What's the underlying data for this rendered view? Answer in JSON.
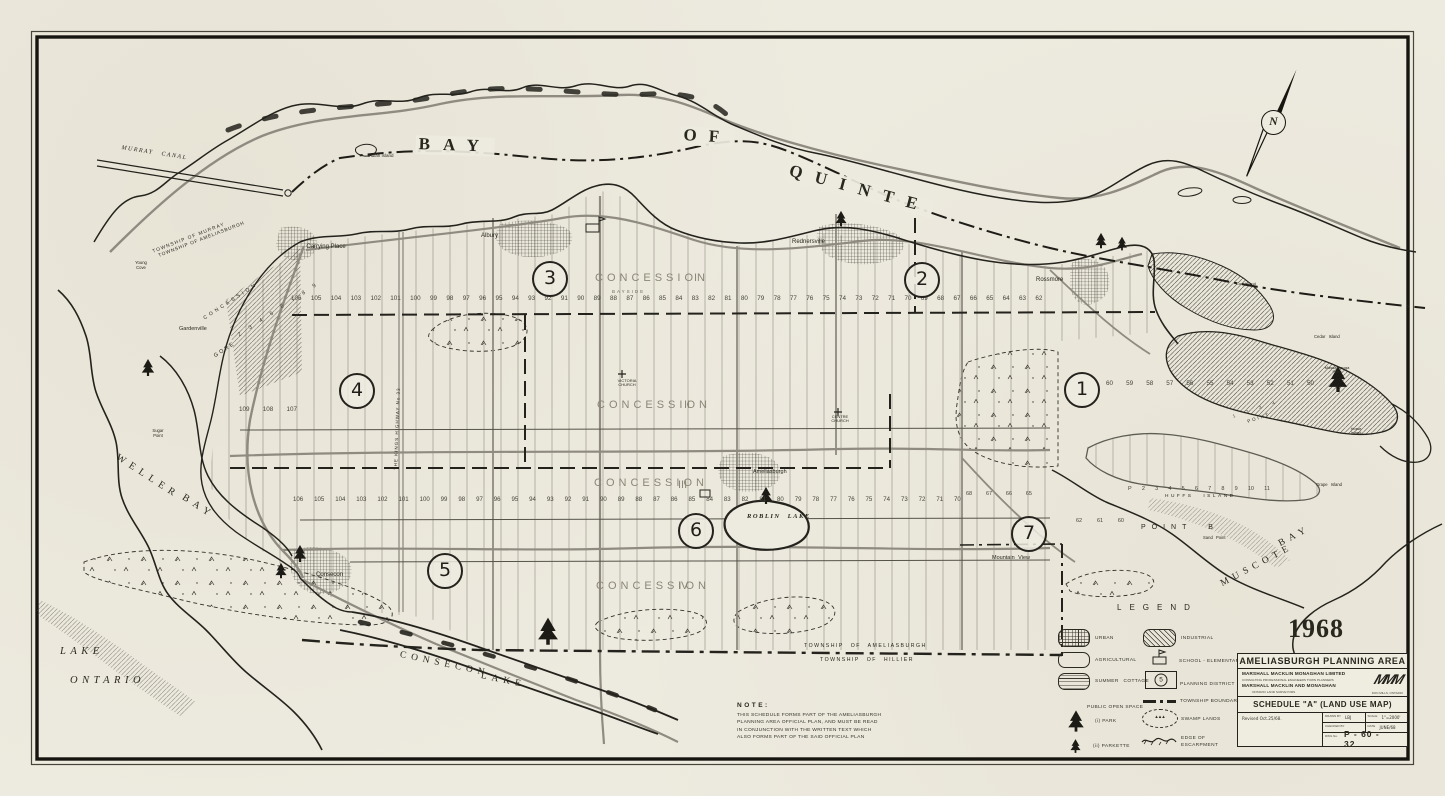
{
  "map": {
    "year": "1968",
    "compass": "N",
    "water": {
      "bay_of_quinte": [
        "BAY",
        "OF",
        "QUINTE"
      ],
      "lake_ontario": [
        "LAKE",
        "ONTARIO"
      ],
      "weller_bay": [
        "WELLER",
        "BAY"
      ],
      "consecon_lake": [
        "CONSECON",
        "LAKE"
      ],
      "muscote_bay": [
        "MUSCOTE",
        "BAY"
      ],
      "roblin_lake": "ROBLIN LAKE",
      "murray_canal": "MURRAY CANAL"
    },
    "places": {
      "carrying_place": "Carrying Place",
      "albury": "Albury",
      "rednersville": "Rednersville",
      "rossmore": "Rossmore",
      "gardenville": "Gardenville",
      "consecon": "Consecon",
      "ameliasburgh": "Ameliasburgh",
      "mountain_view": "Mountain View",
      "victoria_church": "VICTORIA CHURCH",
      "centre_church": "CENTRE CHURCH",
      "young_cove": "Young Cove",
      "sugar_point": "Sugar Point",
      "sand_point": "Sand Point",
      "point_b": "POINT B",
      "point_small": "POINT",
      "gore": "GORE",
      "concession_strip": "CONCESSION",
      "kings_highway": "THE KINGS HIGHWAY No 33"
    },
    "islands": {
      "indian": "Indian Island",
      "huffs": "HUFFS ISLAND",
      "grape": "Grape Island",
      "cow": "Cow Island",
      "cedar": "Cedar Island",
      "horse": "Horse Island",
      "massassauga": "Massassauga Point"
    },
    "townships": {
      "murray": "TOWNSHIP OF MURRAY",
      "ameliasburgh_top": "TOWNSHIP OF AMELIASBURGH",
      "ameliasburgh_bottom": "TOWNSHIP OF AMELIASBURGH",
      "hillier": "TOWNSHIP OF HILLIER"
    },
    "concessions": [
      {
        "label": "CONCESSION",
        "numeral": "I",
        "sub": "BAYSIDE"
      },
      {
        "label": "CONCESSION",
        "numeral": "II"
      },
      {
        "label": "CONCESSION",
        "numeral": "III"
      },
      {
        "label": "CONCESSION",
        "numeral": "IV"
      }
    ],
    "districts": [
      "1",
      "2",
      "3",
      "4",
      "5",
      "6",
      "7"
    ],
    "lot_rows": {
      "concession1": [
        106,
        105,
        104,
        103,
        102,
        101,
        100,
        99,
        98,
        97,
        96,
        95,
        94,
        93,
        92,
        91,
        90,
        89,
        88,
        87,
        86,
        85,
        84,
        83,
        82,
        81,
        80,
        79,
        78,
        77,
        76,
        75,
        74,
        73,
        72,
        71,
        70,
        69,
        68,
        67,
        66,
        65,
        64,
        63,
        62
      ],
      "left_upper": [
        109,
        108,
        107
      ],
      "east": [
        60,
        59,
        58,
        57,
        56,
        55,
        54,
        53,
        52,
        51,
        50
      ],
      "concession3": [
        106,
        105,
        104,
        103,
        102,
        101,
        100,
        99,
        98,
        97,
        96,
        95,
        94,
        93,
        92,
        91,
        90,
        89,
        88,
        87,
        86,
        85,
        84,
        83,
        82,
        81,
        80,
        79,
        78,
        77,
        76,
        75,
        74,
        73,
        72,
        71,
        70
      ],
      "huffs": [
        "P",
        "2",
        "3",
        "4",
        "5",
        "6",
        "7",
        "8",
        "9",
        "10",
        "11"
      ],
      "west_point": [
        68,
        67,
        66,
        65
      ],
      "point_b_row": [
        62,
        61,
        60
      ],
      "gore_lots": [
        2,
        3,
        4,
        5,
        6,
        7,
        8,
        9
      ],
      "point_lots": [
        1,
        2,
        3,
        4
      ]
    }
  },
  "legend": {
    "title": "LEGEND",
    "left": [
      {
        "label": "URBAN"
      },
      {
        "label": "AGRICULTURAL"
      },
      {
        "label": "SUMMER COTTAGE"
      },
      {
        "label": "PUBLIC OPEN SPACE"
      },
      {
        "label": "(i) PARK"
      },
      {
        "label": "(ii) PARKETTE"
      }
    ],
    "right": [
      {
        "label": "INDUSTRIAL"
      },
      {
        "label": "SCHOOL - ELEMENTARY"
      },
      {
        "label": "PLANNING DISTRICT",
        "sample": "5"
      },
      {
        "label": "TOWNSHIP BOUNDARY"
      },
      {
        "label": "SWAMP LANDS"
      },
      {
        "label": "EDGE OF ESCARPMENT"
      }
    ]
  },
  "note": {
    "heading": "NOTE:",
    "lines": [
      "THIS SCHEDULE FORMS PART OF THE AMELIASBURGH",
      "PLANNING AREA OFFICIAL PLAN, AND MUST BE READ",
      "IN CONJUNCTION WITH THE WRITTEN TEXT WHICH",
      "ALSO FORMS PART OF THE SAID OFFICIAL PLAN"
    ]
  },
  "title_block": {
    "title": "AMELIASBURGH  PLANNING  AREA",
    "firm1": "MARSHALL MACKLIN MONAGHAN LIMITED",
    "firm1_sub": "CONSULTING PROFESSIONAL ENGINEERS      TOWN PLANNERS",
    "firm2": "MARSHALL  MACKLIN  AND  MONAGHAN",
    "firm2_sub": "ONTARIO LAND SURVEYORS",
    "firm_location": "DON MILLS, ONTARIO",
    "logo": "MMM",
    "schedule": "SCHEDULE  \"A\"  (LAND  USE  MAP)",
    "revised": "Revised Oct.25/68.",
    "drawn_label": "DRAWN BY",
    "drawn_value": "LBJ",
    "scale_label": "SCALE",
    "scale_value": "1\"=2000'",
    "checked_label": "CHECKED BY",
    "checked_value": "",
    "date_label": "DATE",
    "date_value": "JUNE/68",
    "dwg_label": "DWG No.",
    "dwg_value": "P - 60 - 32"
  }
}
